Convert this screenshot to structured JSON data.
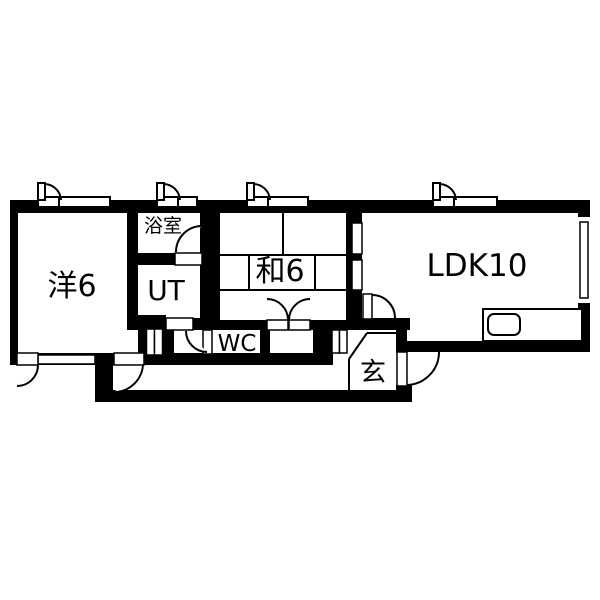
{
  "page": {
    "background": "#ffffff",
    "title": "apartment floor plan"
  },
  "floorplan": {
    "type": "floor-plan",
    "wall_color": "#000000",
    "floor_color": "#ffffff",
    "line_color": "#000000",
    "rooms": {
      "western": {
        "label": "洋6"
      },
      "bath": {
        "label": "浴室"
      },
      "utility": {
        "label": "UT"
      },
      "japanese": {
        "label": "和6"
      },
      "toilet": {
        "label": "WC"
      },
      "living": {
        "label": "LDK10"
      },
      "entrance": {
        "label": "玄"
      }
    },
    "fixtures": {
      "kitchen_counter": "kitchen counter with sink",
      "tatami": "6-mat tatami grid in japanese room",
      "windows": 5,
      "hinged_doors": 7,
      "double_door": 1,
      "sliding_panels": 2
    }
  }
}
